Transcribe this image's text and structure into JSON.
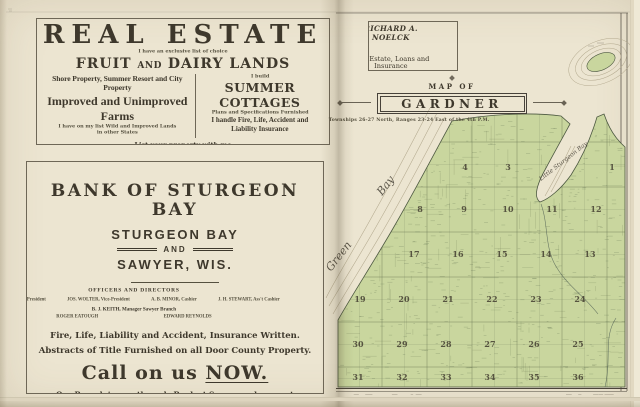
{
  "left_page": {
    "real_estate_ad": {
      "title": "REAL ESTATE",
      "tagline": "I have an exclusive list of choice",
      "fruit_pre": "FRUIT",
      "fruit_and": "AND",
      "fruit_post": "DAIRY LANDS",
      "col_left_1": "Shore Property, Summer Resort and City Property",
      "col_left_2": "Improved and Unimproved Farms",
      "col_left_3": "I have on my list Wild and Improved Lands",
      "col_left_4": "in other States",
      "col_right_1": "I build",
      "col_right_2": "SUMMER COTTAGES",
      "col_right_3": "Plans and Specifications Furnished",
      "col_right_4": "I handle Fire, Life, Accident and",
      "col_right_5": "Liability Insurance",
      "list_line": "List your property with me",
      "name": "RICHARD A. NOELCK",
      "office_line1": "Main Office in Merchants Exchange Bank Bldg.  -  Phone 89",
      "office_line2": "Branch Office Next to New A. & W. Depot  -  Phone 98",
      "city": "STURGEON BAY, WIS."
    },
    "bank_ad": {
      "title": "BANK OF STURGEON BAY",
      "city1": "STURGEON BAY",
      "and_label": "AND",
      "city2": "SAWYER, WIS.",
      "officers_heading": "OFFICERS AND DIRECTORS",
      "officers": [
        "HENRY FETZER, President",
        "JOS. WOLTER, Vice-President",
        "A. B. MINOR, Cashier",
        "J. H. STEWART, Ass't Cashier"
      ],
      "manager_line": "B. J. KEITH, Manager Sawyer Branch",
      "directors": [
        "ROGER EATOUGH",
        "EDWARD REYNOLDS"
      ],
      "insurance_line": "Fire, Life, Liability and Accident, Insurance Written.",
      "abstracts_line": "Abstracts of Title Furnished on all Door County Property.",
      "cta_pre": "Call on us ",
      "cta_emph": "NOW.",
      "closing": "Our Branch is now the only Bank at Sawyer and we want every person living at Sawyer and vicinity to do their banking business with us."
    }
  },
  "right_page": {
    "card": {
      "name": "RICHARD A. NOELCK",
      "line1": "Real Estate, Loans and Insurance",
      "line2": "ABSTRACTS OF TITLE",
      "line3": "Merchants Exchange Bank Building",
      "line4": "STURGEON BAY, WISCONSIN",
      "line5": "Phone 89"
    },
    "map": {
      "kicker": "MAP OF",
      "title": "GARDNER",
      "subtitle": "Townships 26-27 North, Ranges 23-24 East of the 4th P.M.",
      "water_labels": [
        {
          "text": "Green",
          "x": 331,
          "y": 272,
          "rotate": -52,
          "size": 11
        },
        {
          "text": "Bay",
          "x": 382,
          "y": 196,
          "rotate": -52,
          "size": 11
        },
        {
          "text": "Little Sturgeon Bay",
          "x": 541,
          "y": 181,
          "rotate": -38,
          "size": 6
        }
      ],
      "sections": [
        {
          "n": "4",
          "x": 465,
          "y": 170
        },
        {
          "n": "3",
          "x": 508,
          "y": 170
        },
        {
          "n": "1",
          "x": 612,
          "y": 170
        },
        {
          "n": "8",
          "x": 420,
          "y": 212
        },
        {
          "n": "9",
          "x": 464,
          "y": 212
        },
        {
          "n": "10",
          "x": 508,
          "y": 212
        },
        {
          "n": "11",
          "x": 552,
          "y": 212
        },
        {
          "n": "12",
          "x": 596,
          "y": 212
        },
        {
          "n": "18",
          "x": 370,
          "y": 257
        },
        {
          "n": "17",
          "x": 414,
          "y": 257
        },
        {
          "n": "16",
          "x": 458,
          "y": 257
        },
        {
          "n": "15",
          "x": 502,
          "y": 257
        },
        {
          "n": "14",
          "x": 546,
          "y": 257
        },
        {
          "n": "13",
          "x": 590,
          "y": 257
        },
        {
          "n": "19",
          "x": 360,
          "y": 302
        },
        {
          "n": "20",
          "x": 404,
          "y": 302
        },
        {
          "n": "21",
          "x": 448,
          "y": 302
        },
        {
          "n": "22",
          "x": 492,
          "y": 302
        },
        {
          "n": "23",
          "x": 536,
          "y": 302
        },
        {
          "n": "24",
          "x": 580,
          "y": 302
        },
        {
          "n": "30",
          "x": 358,
          "y": 347
        },
        {
          "n": "29",
          "x": 402,
          "y": 347
        },
        {
          "n": "28",
          "x": 446,
          "y": 347
        },
        {
          "n": "27",
          "x": 490,
          "y": 347
        },
        {
          "n": "26",
          "x": 534,
          "y": 347
        },
        {
          "n": "25",
          "x": 578,
          "y": 347
        },
        {
          "n": "31",
          "x": 358,
          "y": 380
        },
        {
          "n": "32",
          "x": 402,
          "y": 380
        },
        {
          "n": "33",
          "x": 446,
          "y": 380
        },
        {
          "n": "34",
          "x": 490,
          "y": 380
        },
        {
          "n": "35",
          "x": 534,
          "y": 380
        },
        {
          "n": "36",
          "x": 578,
          "y": 380
        }
      ],
      "colors": {
        "land": "#c9d69e",
        "water": "#ece5d1",
        "contour": "#b3a98e",
        "grid": "#5c6a4a",
        "ink": "#3e382c",
        "stream": "#3f4f49"
      }
    }
  }
}
